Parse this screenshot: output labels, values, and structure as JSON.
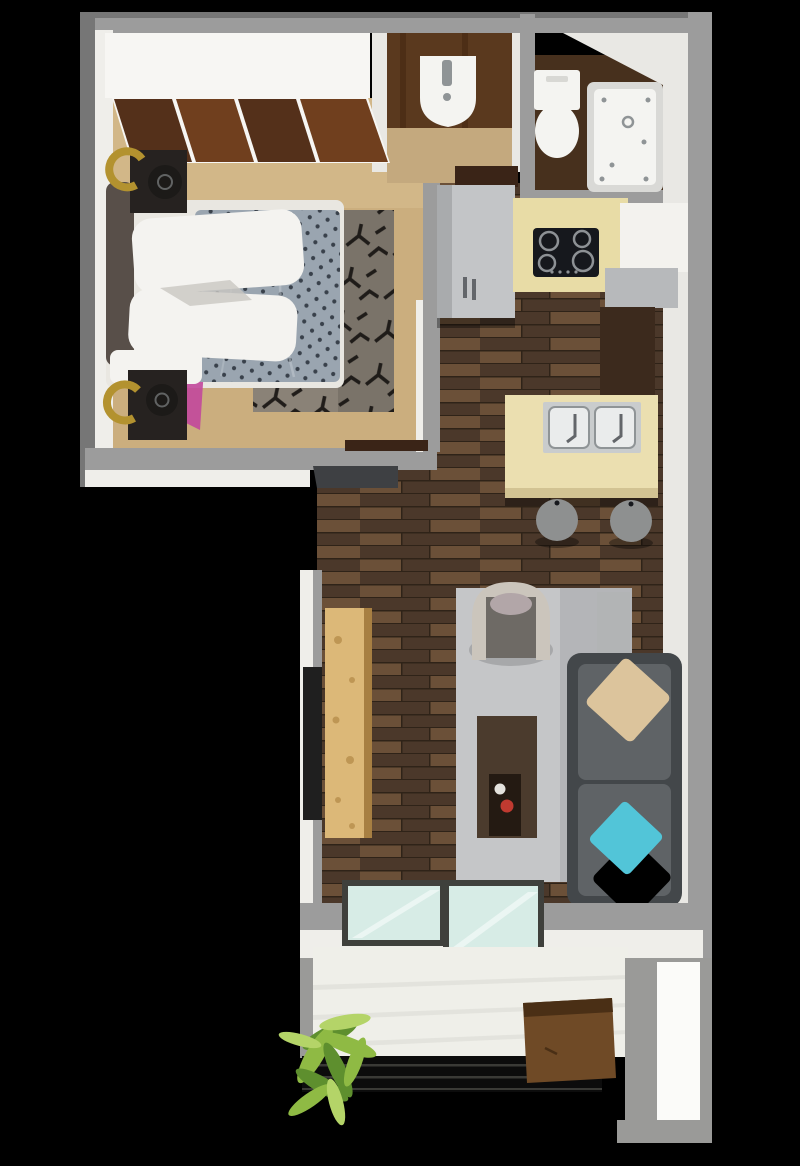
{
  "image_description": "3D rendered top-down floor plan of a studio apartment on a black background",
  "rooms": {
    "bedroom": "bedroom with closet, double bed, nightstands, patterned rug",
    "bathroom_sink": "powder room with pedestal sink",
    "bathroom_wc": "bathroom with toilet and jetted bathtub",
    "kitchen": "kitchen with fridge cabinet, cooktop counter, island with double sink and two stools",
    "living": "living room with armchair, coffee table, sideboard, TV and sofa",
    "balcony": "balcony with plant, wood table and railing"
  },
  "colors": {
    "background": "#000000",
    "wallGray": "#9c9c9c",
    "wallGrayDark": "#767676",
    "wallFaceWhite": "#efeeea",
    "wallInnerWhite": "#e9e8e4",
    "carpet": "#cbae7e",
    "carpetLight": "#dcc495",
    "closetWhite": "#f7f6f3",
    "closetWood": "#703f1e",
    "closetWoodDark": "#54301a",
    "bedBase": "#e9e7e1",
    "pillowWhite": "#f4f3f0",
    "pillowShadow": "#c9c7c2",
    "magenta": "#c2489c",
    "duvet": "#9aa5b0",
    "duvetDark": "#39414b",
    "duvetFold": "#c2cad2",
    "headboard": "#584f49",
    "nightstand": "#262220",
    "lampGold": "#b3922f",
    "lampDark": "#1c1a18",
    "rugBase": "#8a8277",
    "rugBaseDark": "#7a7369",
    "rugPattern": "#151210",
    "bathWoodWall": "#5a391e",
    "bathWoodStreak": "#4a2c14",
    "bathFloorTan": "#c4a97e",
    "porcelain": "#f4f4f1",
    "porcelainShadow": "#d8d8d4",
    "tubRim": "#d9d9d6",
    "fixtureGray": "#8f9496",
    "bathFloorDark": "#47301d",
    "cabinetGray": "#c3c5c7",
    "cabinetGraySide": "#a9abad",
    "handleDark": "#63666a",
    "counterCream": "#e8dca6",
    "cooktop": "#16181d",
    "burner": "#8d9195",
    "upperCabWhite": "#f3f2ee",
    "shelfGray": "#b7b9bb",
    "pantryBrown": "#3c2a1d",
    "islandCream": "#ebdfb0",
    "islandSide": "#d2c393",
    "steel": "#c9cccd",
    "sinkInner": "#eaecec",
    "stoolGray": "#8e9090",
    "woodA": "#5c4531",
    "woodB": "#4b382a",
    "woodC": "#6b5038",
    "woodSeam": "#2f2318",
    "livingRug": "#c5c6c8",
    "livingRugShade": "#b4b5b8",
    "sofa": "#5f6366",
    "sofaDark": "#43474a",
    "pillowTan": "#dcc49c",
    "pillowCyan": "#52c5d8",
    "chairShell": "#cbc5bc",
    "chairSeat": "#6e6a65",
    "chairCushion": "#b2a6a8",
    "coffeeTable": "#4b3b2d",
    "coffeeTray": "#241a12",
    "mugRed": "#c03a30",
    "dishWhite": "#e4e2dd",
    "sideboard": "#dcb878",
    "sideboardKnot": "#b78e4c",
    "sideboardSide": "#a77f42",
    "tv": "#1f1f1f",
    "sideTable": "#b2b4b5",
    "entryMat": "#3e4043",
    "threshold": "#3a2417",
    "glassFrame": "#3f403c",
    "glass": "#d7ece6",
    "balconyFloor": "#efefe9",
    "balconyShade": "#d9d9d2",
    "structureGray": "#9a9a98",
    "panelWhite": "#fbfbf9",
    "railing": "#0c0c0c",
    "railingLine": "#3a3a36",
    "benchWood": "#6f4a26",
    "benchWoodDark": "#4a2f15",
    "plantA": "#8fba44",
    "plantB": "#5e8f2e",
    "plantC": "#b4d468"
  }
}
